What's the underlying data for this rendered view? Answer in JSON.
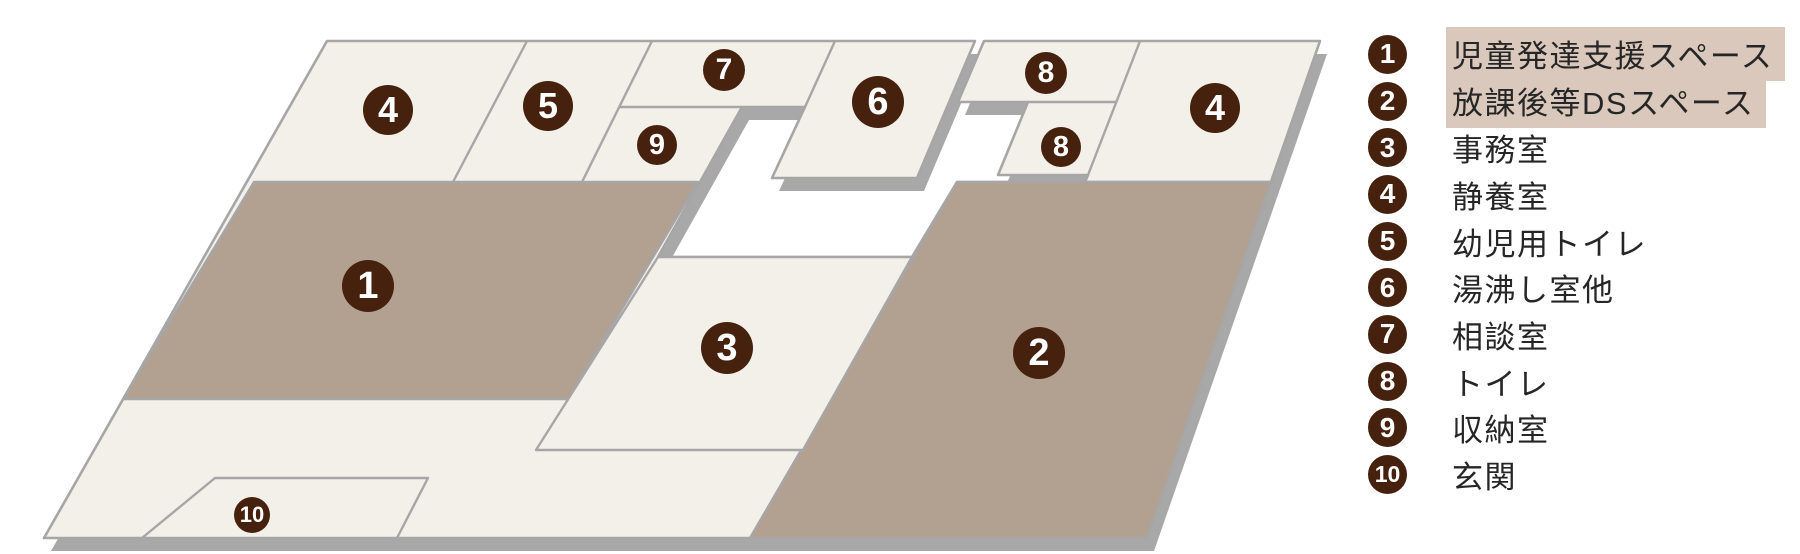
{
  "colors": {
    "cream": "#f3f0e9",
    "accent": "#b2a090",
    "line": "#a6a6a6",
    "slab": "#a8a8a8",
    "badge": "#45210e",
    "highlight_bg": "#d9c8bb",
    "text": "#262626"
  },
  "plan": {
    "badges": [
      {
        "num": "1",
        "room": "児童発達支援スペース",
        "x": 368,
        "y": 286,
        "r": 26
      },
      {
        "num": "2",
        "room": "放課後等DSスペース",
        "x": 1039,
        "y": 353,
        "r": 26
      },
      {
        "num": "3",
        "room": "事務室",
        "x": 727,
        "y": 348,
        "r": 26
      },
      {
        "num": "4",
        "room": "静養室",
        "x": 388,
        "y": 110,
        "r": 25
      },
      {
        "num": "4",
        "room": "静養室",
        "x": 1215,
        "y": 108,
        "r": 25
      },
      {
        "num": "5",
        "room": "幼児用トイレ",
        "x": 548,
        "y": 106,
        "r": 25
      },
      {
        "num": "6",
        "room": "湯沸し室他",
        "x": 878,
        "y": 102,
        "r": 26
      },
      {
        "num": "7",
        "room": "相談室",
        "x": 724,
        "y": 70,
        "r": 21
      },
      {
        "num": "8",
        "room": "トイレ",
        "x": 1046,
        "y": 73,
        "r": 21
      },
      {
        "num": "8",
        "room": "トイレ",
        "x": 1061,
        "y": 147,
        "r": 20
      },
      {
        "num": "9",
        "room": "収納室",
        "x": 657,
        "y": 145,
        "r": 20
      },
      {
        "num": "10",
        "room": "玄関",
        "x": 252,
        "y": 515,
        "r": 18
      }
    ]
  },
  "legend": {
    "items": [
      {
        "num": "1",
        "label": "児童発達支援スペース",
        "highlighted": true
      },
      {
        "num": "2",
        "label": "放課後等DSスペース",
        "highlighted": true
      },
      {
        "num": "3",
        "label": "事務室",
        "highlighted": false
      },
      {
        "num": "4",
        "label": "静養室",
        "highlighted": false
      },
      {
        "num": "5",
        "label": "幼児用トイレ",
        "highlighted": false
      },
      {
        "num": "6",
        "label": "湯沸し室他",
        "highlighted": false
      },
      {
        "num": "7",
        "label": "相談室",
        "highlighted": false
      },
      {
        "num": "8",
        "label": "トイレ",
        "highlighted": false
      },
      {
        "num": "9",
        "label": "収納室",
        "highlighted": false
      },
      {
        "num": "10",
        "label": "玄関",
        "highlighted": false
      }
    ]
  }
}
